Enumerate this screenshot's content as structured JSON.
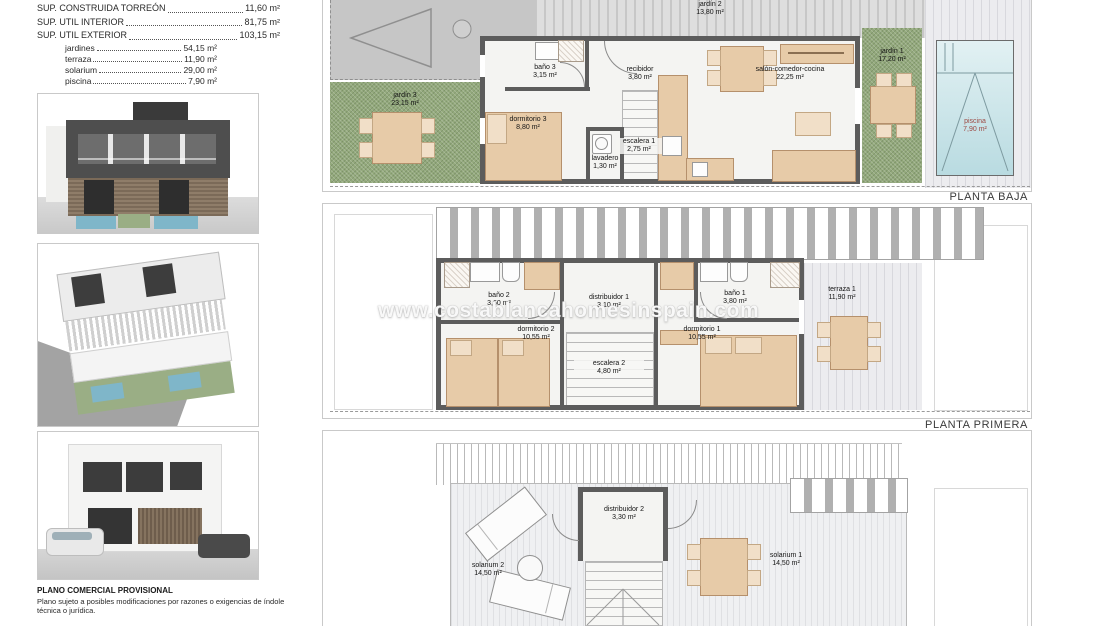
{
  "summary": {
    "lines": [
      {
        "label": "SUP. CONSTRUIDA TORREÓN",
        "value": "11,60 m²"
      },
      {
        "label": "SUP. UTIL INTERIOR",
        "value": "81,75 m²"
      },
      {
        "label": "SUP. UTIL EXTERIOR",
        "value": "103,15 m²"
      }
    ],
    "sublines": [
      {
        "label": "jardines",
        "value": "54,15 m²"
      },
      {
        "label": "terraza",
        "value": "11,90 m²"
      },
      {
        "label": "solarium",
        "value": "29,00 m²"
      },
      {
        "label": "piscina",
        "value": "7,90 m²"
      }
    ]
  },
  "renders": [
    {
      "name": "render-front-elevation"
    },
    {
      "name": "render-aerial-view"
    },
    {
      "name": "render-corner-view"
    }
  ],
  "watermark": {
    "text": "www.costablancahomesinspain.com"
  },
  "plans": {
    "baja": {
      "label": "PLANTA BAJA",
      "rooms": {
        "jardin2": {
          "name": "jardín 2",
          "area": "13,80 m²"
        },
        "jardin3": {
          "name": "jardín 3",
          "area": "23,15 m²"
        },
        "jardin1": {
          "name": "jardín 1",
          "area": "17,20 m²"
        },
        "bano3": {
          "name": "baño 3",
          "area": "3,15 m²"
        },
        "recibidor": {
          "name": "recibidor",
          "area": "3,80 m²"
        },
        "dormitorio3": {
          "name": "dormitorio 3",
          "area": "8,80 m²"
        },
        "lavadero": {
          "name": "lavadero",
          "area": "1,30 m²"
        },
        "escalera1": {
          "name": "escalera 1",
          "area": "2,75 m²"
        },
        "salon": {
          "name": "salón-comedor-cocina",
          "area": "22,25 m²"
        },
        "piscina": {
          "name": "piscina",
          "area": "7,90 m²"
        }
      }
    },
    "primera": {
      "label": "PLANTA PRIMERA",
      "rooms": {
        "bano2": {
          "name": "baño 2",
          "area": "3,60 m²"
        },
        "distribuidor1": {
          "name": "distribuidor 1",
          "area": "3,10 m²"
        },
        "bano1": {
          "name": "baño 1",
          "area": "3,80 m²"
        },
        "dormitorio2": {
          "name": "dormitorio 2",
          "area": "10,55 m²"
        },
        "dormitorio1": {
          "name": "dormitorio 1",
          "area": "10,55 m²"
        },
        "escalera2": {
          "name": "escalera 2",
          "area": "4,80 m²"
        },
        "terraza1": {
          "name": "terraza 1",
          "area": "11,90 m²"
        }
      }
    },
    "solarium": {
      "rooms": {
        "distribuidor2": {
          "name": "distribuidor 2",
          "area": "3,30 m²"
        },
        "solarium1": {
          "name": "solarium 1",
          "area": "14,50 m²"
        },
        "solarium2": {
          "name": "solarium 2",
          "area": "14,50 m²"
        }
      }
    }
  },
  "footer": {
    "title": "PLANO COMERCIAL PROVISIONAL",
    "disclaimer": "Plano sujeto a posibles modificaciones por razones o exigencias de índole técnica o jurídica."
  },
  "colors": {
    "wall": "#5c5c5c",
    "garden": "#93a97c",
    "pool": "#bcdde3",
    "furniture": "#e7cba8",
    "pool_label": "#9c4a44"
  }
}
